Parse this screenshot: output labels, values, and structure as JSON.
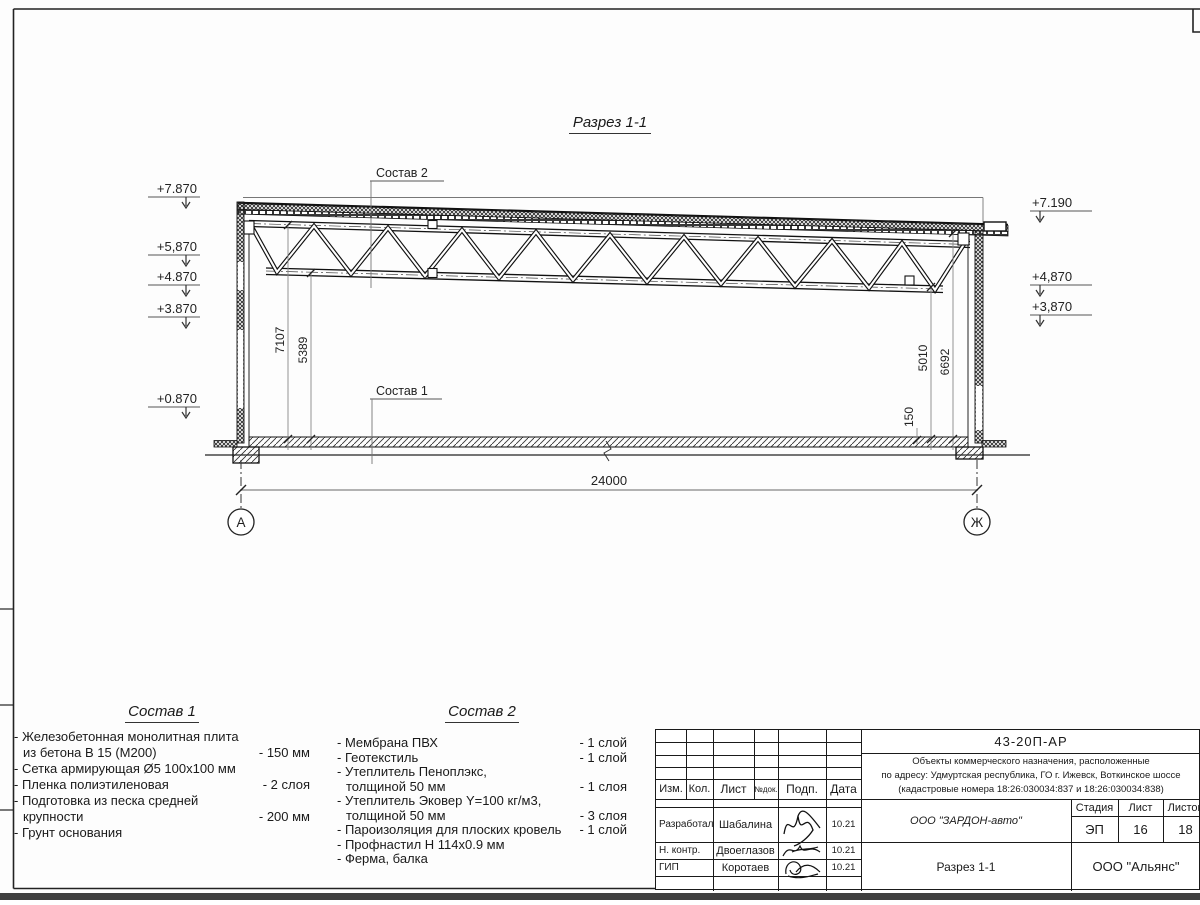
{
  "sheet": {
    "title": "Разрез 1-1"
  },
  "drawing": {
    "labels": {
      "comp1_ref": "Состав 1",
      "comp2_ref": "Состав 2"
    },
    "elev_left": [
      "+7.870",
      "+5,870",
      "+4.870",
      "+3.870",
      "+0.870"
    ],
    "elev_right": [
      "+7.190",
      "+4,870",
      "+3,870"
    ],
    "dims": {
      "span": "24000",
      "left_outer": "7107",
      "left_inner": "5389",
      "right_inner": "5010",
      "right_outer": "6692",
      "slab": "150"
    },
    "axis_left": "А",
    "axis_right": "Ж"
  },
  "comp1": {
    "title": "Состав 1",
    "rows": [
      [
        "- Железобетонная  монолитная плита",
        ""
      ],
      [
        "из бетона В 15 (М200)",
        "- 150 мм"
      ],
      [
        "- Сетка армирующая Ø5 100x100 мм",
        ""
      ],
      [
        "- Пленка полиэтиленовая",
        "-  2 слоя"
      ],
      [
        "- Подготовка из песка средней",
        ""
      ],
      [
        "крупности",
        "- 200 мм"
      ],
      [
        "- Грунт основания",
        ""
      ]
    ]
  },
  "comp2": {
    "title": "Состав 2",
    "rows": [
      [
        "- Мембрана ПВХ",
        "- 1 слой"
      ],
      [
        "- Геотекстиль",
        "- 1 слой"
      ],
      [
        "- Утеплитель Пеноплэкс,",
        ""
      ],
      [
        "толщиной 50 мм",
        "- 1 слоя"
      ],
      [
        "- Утеплитель Эковер Y=100 кг/м3,",
        ""
      ],
      [
        "толщиной 50 мм",
        "- 3 слоя"
      ],
      [
        "- Пароизоляция для плоских кровель",
        "- 1 слой"
      ],
      [
        "- Профнастил Н 114х0.9 мм",
        ""
      ],
      [
        "- Ферма, балка",
        ""
      ]
    ]
  },
  "tb": {
    "doc": "43-20П-АР",
    "desc1": "Объекты коммерческого назначения, расположенные",
    "desc2": "по адресу: Удмуртская республика, ГО г. Ижевск, Воткинское шоссе",
    "desc3": "(кадастровые номера 18:26:030034:837 и 18:26:030034:838)",
    "h_izm": "Изм.",
    "h_kol": "Кол.",
    "h_list": "Лист",
    "h_ndok": "№док.",
    "h_podp": "Подп.",
    "h_data": "Дата",
    "r1_role": "Разработал",
    "r1_name": "Шабалина",
    "r1_date": "10.21",
    "r2_role": "Н. контр.",
    "r2_name": "Двоеглазов",
    "r2_date": "10.21",
    "r3_role": "ГИП",
    "r3_name": "Коротаев",
    "r3_date": "10.21",
    "company": "ООО \"ЗАРДОН-авто\"",
    "h_stage": "Стадия",
    "h_sheet": "Лист",
    "h_sheets": "Листов",
    "stage": "ЭП",
    "sheet_no": "16",
    "sheets_total": "18",
    "drawing_name": "Разрез 1-1",
    "org": "ООО \"Альянс\""
  }
}
